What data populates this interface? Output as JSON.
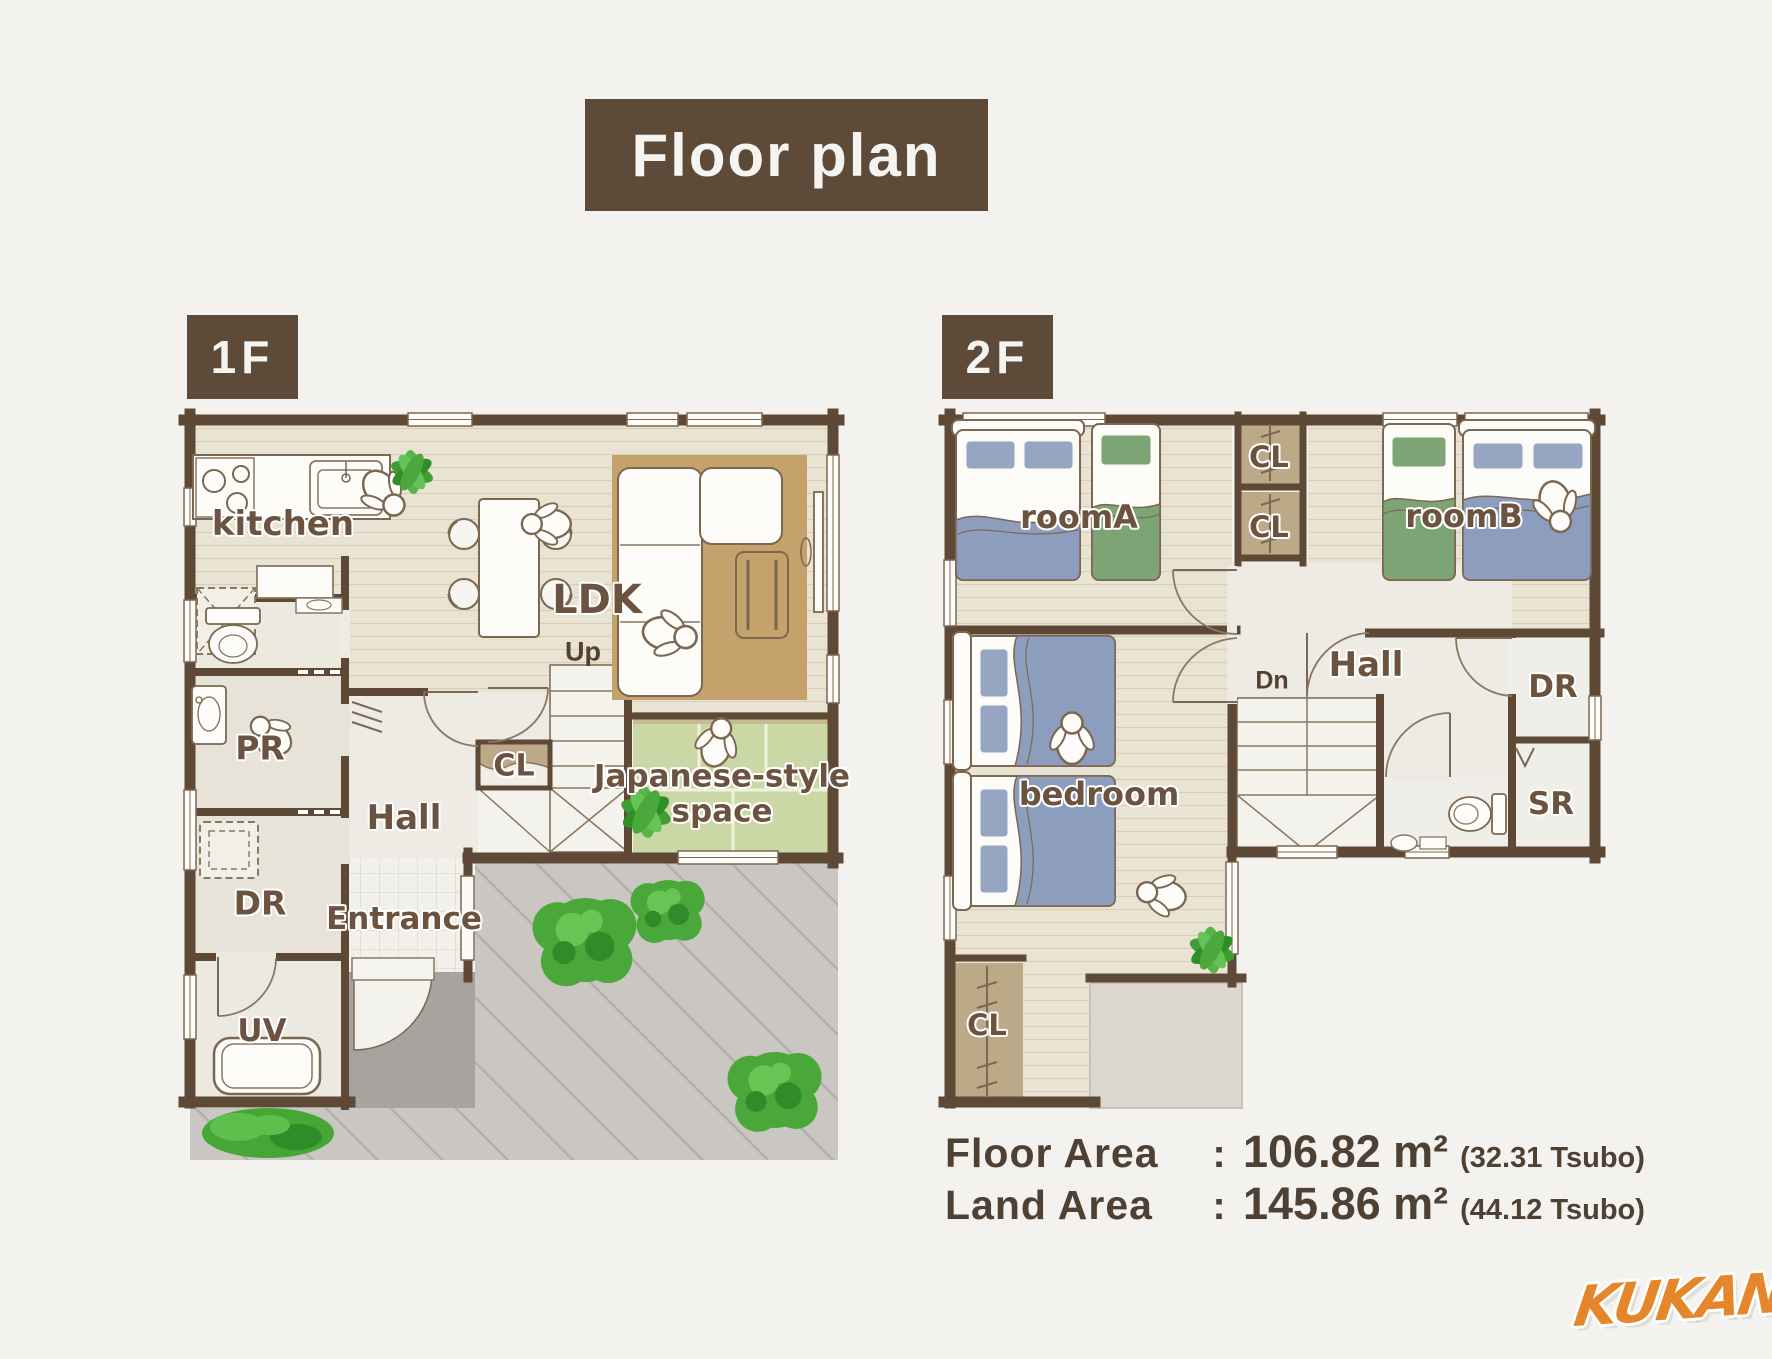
{
  "title": "Floor plan",
  "floors": {
    "f1": {
      "label": "1F",
      "rooms": {
        "kitchen": "kitchen",
        "ldk": "LDK",
        "up": "Up",
        "cl": "CL",
        "hall": "Hall",
        "japanese1": "Japanese-style",
        "japanese2": "space",
        "entrance": "Entrance",
        "pr": "PR",
        "dr": "DR",
        "uv": "UV"
      }
    },
    "f2": {
      "label": "2F",
      "rooms": {
        "room_a": "roomA",
        "cl_top": "CL",
        "cl_mid": "CL",
        "room_b": "roomB",
        "hall": "Hall",
        "dn": "Dn",
        "dr": "DR",
        "sr": "SR",
        "bedroom": "bedroom",
        "cl_bottom": "CL"
      }
    }
  },
  "areas": {
    "floor": {
      "label": "Floor Area",
      "colon": ":",
      "value": "106.82 m²",
      "tsubo": "(32.31 Tsubo)"
    },
    "land": {
      "label": "Land Area",
      "colon": ":",
      "value": "145.86 m²",
      "tsubo": "(44.12 Tsubo)"
    }
  },
  "logo": "KUKAN",
  "colors": {
    "wall_brown": "#5d4a39",
    "accent_orange": "#e5862b",
    "bed_blue": "#8d9dbe",
    "bed_green": "#7ca474",
    "tatami_green": "#cbd8a6",
    "closet_tan": "#bca987",
    "label_brown": "#6b5340",
    "yard_gray": "#cac7c2",
    "porch_gray": "#a7a39e"
  }
}
